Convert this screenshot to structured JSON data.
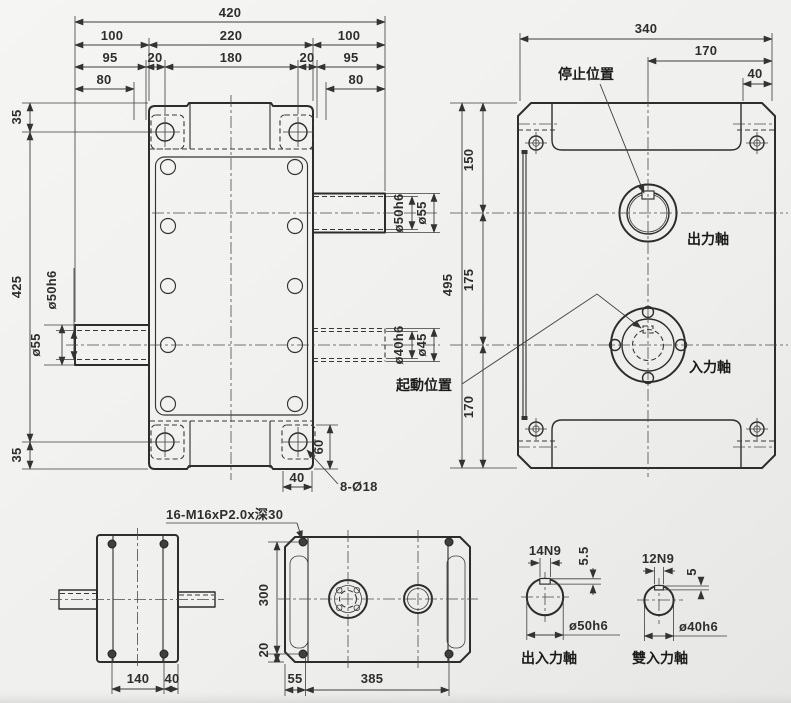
{
  "colors": {
    "background": "#f0f0ee",
    "body_green": "#c3d4c8",
    "metal_gray": "#d7dadb",
    "line": "#2d2d2d"
  },
  "front_view": {
    "d420": "420",
    "d100_left": "100",
    "d220": "220",
    "d100_right": "100",
    "d95_left": "95",
    "d20_left": "20",
    "d180": "180",
    "d20_right": "20",
    "d95_right": "95",
    "d80_left": "80",
    "d80_right": "80",
    "d35_top": "35",
    "d425": "425",
    "d35_bottom": "35",
    "left_shaft_core": "ø50h6",
    "left_shaft_dia": "ø55",
    "out_shaft_core": "ø50h6",
    "out_shaft_dia": "ø55",
    "in_shaft_core": "ø40h6",
    "in_shaft_dia": "ø45",
    "pad_width": "40",
    "pad_height": "60",
    "holes_label": "8-Ø18"
  },
  "side_view": {
    "d340": "340",
    "d170_top": "170",
    "d40": "40",
    "d150": "150",
    "d175": "175",
    "d170_left": "170",
    "d495": "495",
    "stop_position": "停止位置",
    "output_shaft": "出力軸",
    "input_shaft": "入力軸",
    "start_position": "起動位置"
  },
  "end_view": {
    "d140": "140",
    "d40": "40"
  },
  "top_view": {
    "tap_label": "16-M16xP2.0x深30",
    "d300": "300",
    "d20": "20",
    "d55": "55",
    "d385": "385"
  },
  "sections": {
    "inout": {
      "keyway": "14N9",
      "key_depth": "5.5",
      "dia": "ø50h6",
      "label": "出入力軸"
    },
    "dual": {
      "keyway": "12N9",
      "key_depth": "5",
      "dia": "ø40h6",
      "label": "雙入力軸"
    }
  }
}
